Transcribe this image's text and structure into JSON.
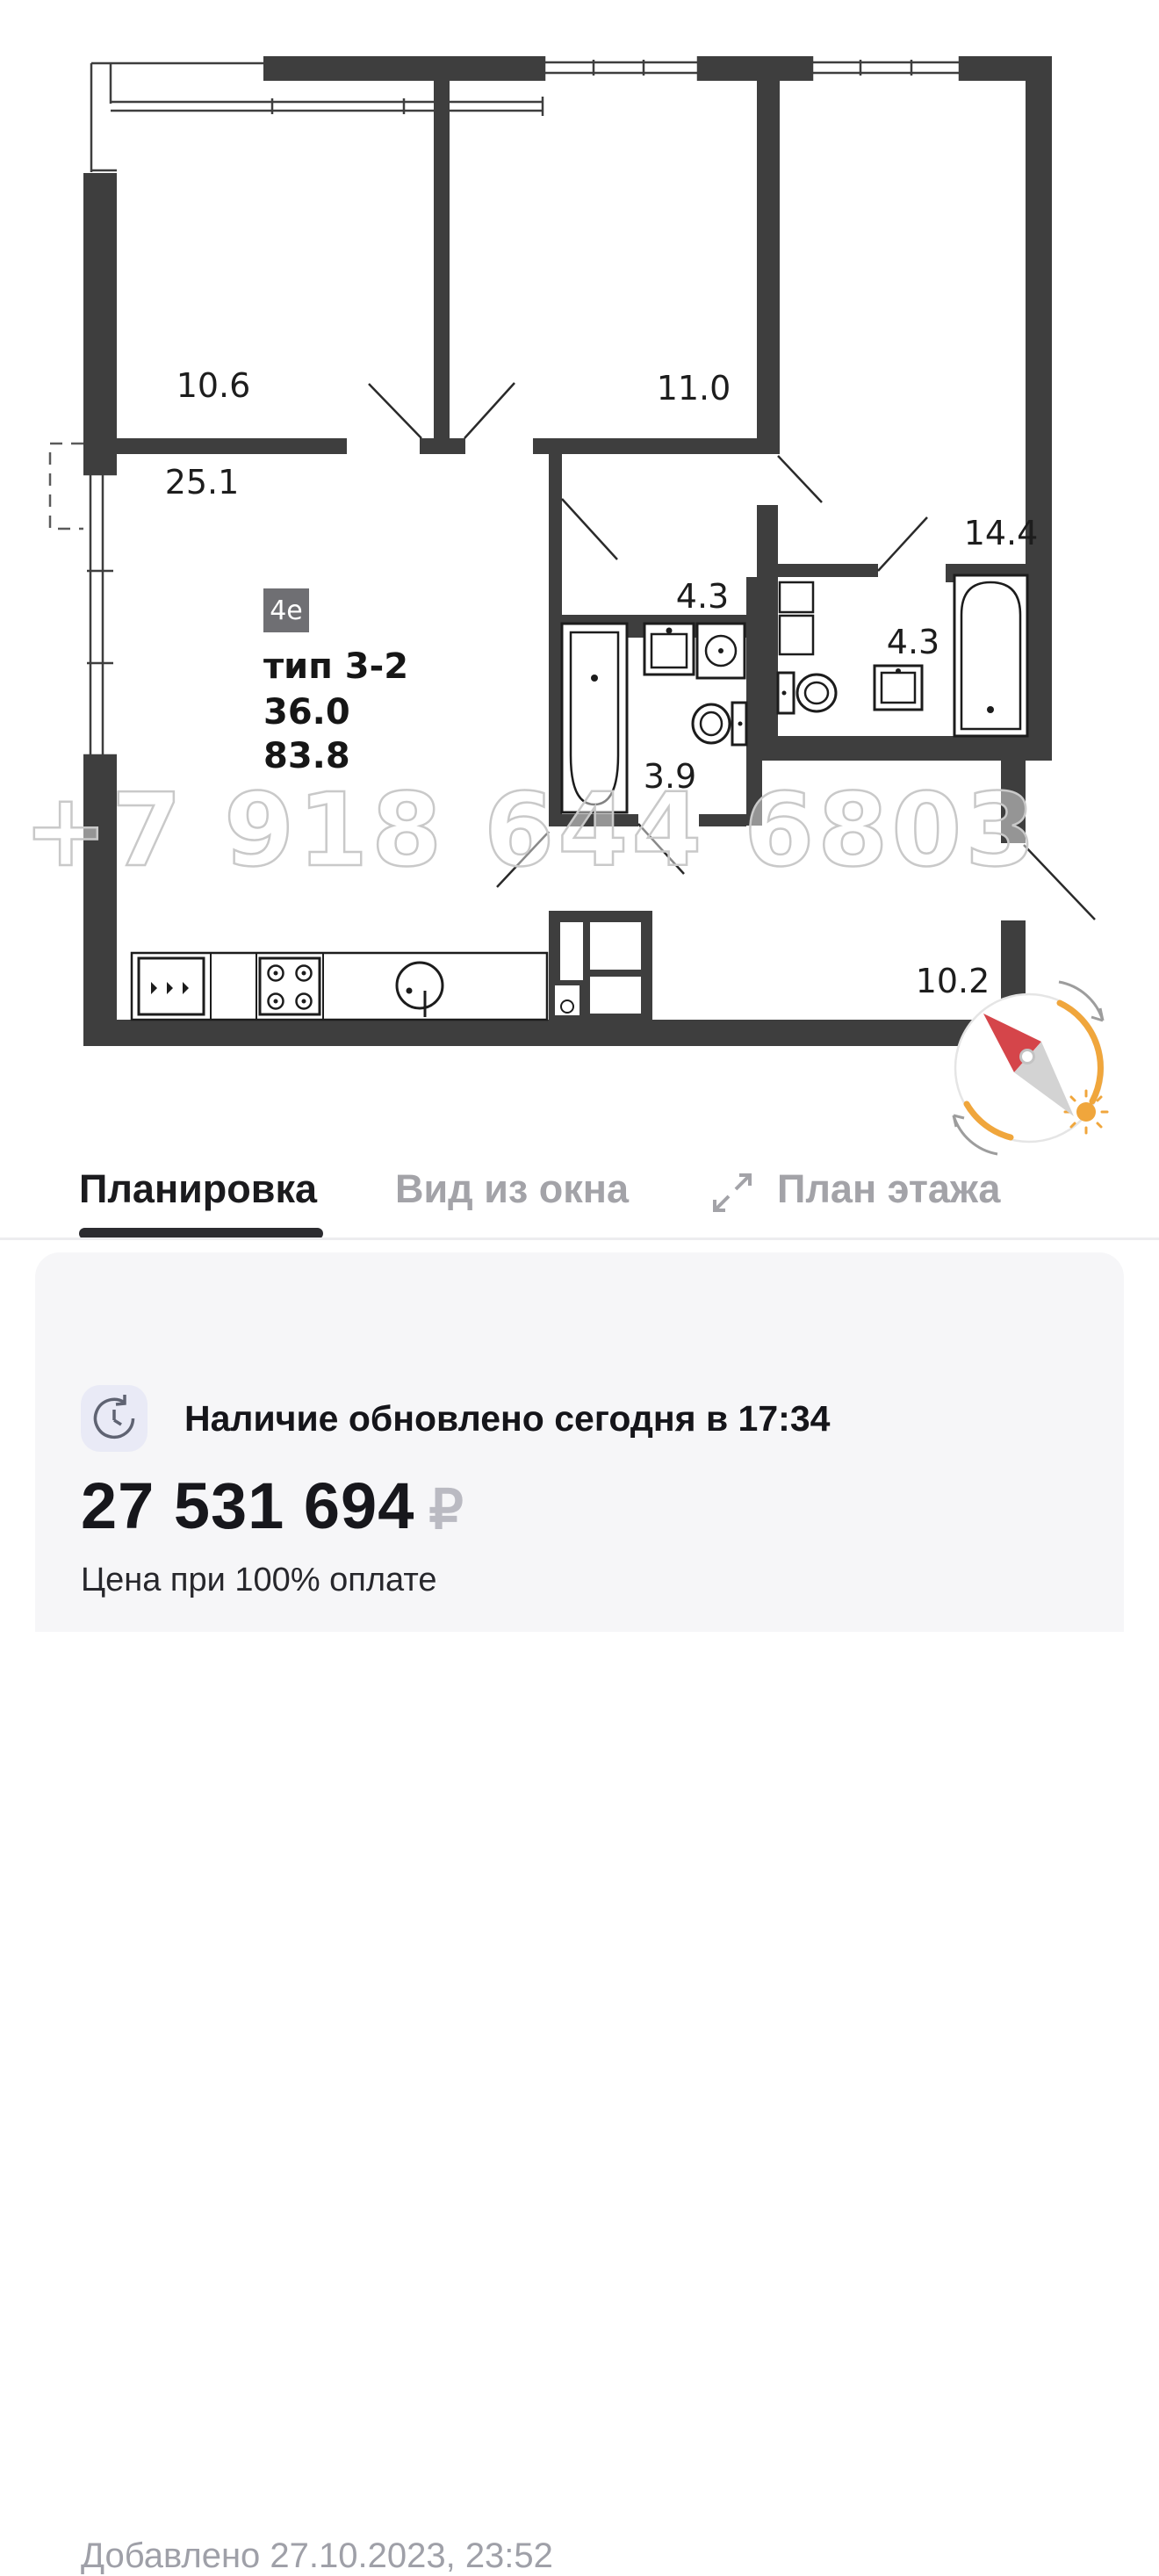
{
  "floorplan": {
    "watermark": "+7 918 644 6803",
    "badge": "4е",
    "type_label": "тип 3-2",
    "area_living": "36.0",
    "area_total": "83.8",
    "rooms": [
      {
        "name": "bedroom-top-left",
        "label": "10.6"
      },
      {
        "name": "living-kitchen",
        "label": "25.1"
      },
      {
        "name": "bedroom-middle",
        "label": "11.0"
      },
      {
        "name": "bedroom-right",
        "label": "14.4"
      },
      {
        "name": "hall-top",
        "label": "4.3"
      },
      {
        "name": "bathroom-right",
        "label": "4.3"
      },
      {
        "name": "bathroom-left",
        "label": "3.9"
      },
      {
        "name": "entrance-hall",
        "label": "10.2"
      }
    ],
    "colors": {
      "wall": "#3e3e3e",
      "watermark": "#c9c9c9",
      "compass_orange": "#f0a63c",
      "compass_red": "#d5454a"
    }
  },
  "tabs": {
    "planirovka": "Планировка",
    "vid_iz_okna": "Вид из окна",
    "plan_etazha": "План этажа"
  },
  "card": {
    "added": "Добавлено 27.10.2023, 23:52",
    "availability": "Наличие обновлено сегодня в 17:34",
    "price": "27 531 694",
    "currency": "₽",
    "price_note": "Цена при 100% оплате"
  }
}
